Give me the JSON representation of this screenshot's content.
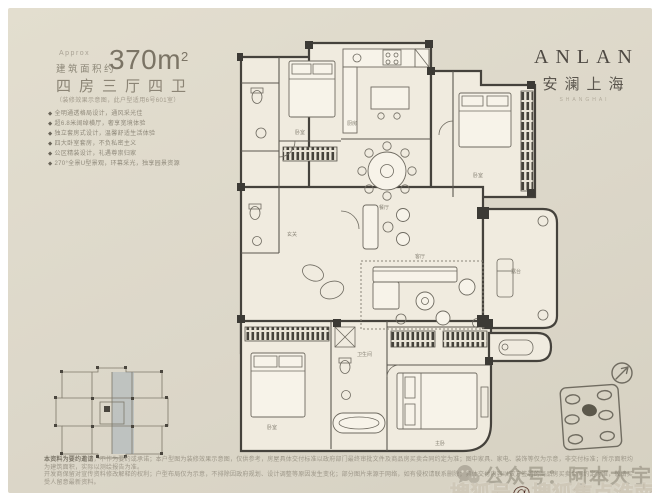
{
  "header": {
    "approx": "Approx",
    "area_label": "建筑面积约",
    "area_number": "370m",
    "area_sup": "2",
    "layout": "四房三厅四卫",
    "note": "（装修效果示意图，此户型适用6号601室）",
    "bullet": "◆",
    "features": [
      "全明通透格局设计，通风采光佳",
      "超6.8米阔绰横厅，奢享宽境体验",
      "独立套房式设计，温馨舒适生活体验",
      "四大卧室套房，不负私密主义",
      "公区精装设计，礼遇尊崇归家",
      "270°全景U型景观，环幕采光，独享园景资源"
    ]
  },
  "brand": {
    "name_en": "ANLAN",
    "name_cn": "安澜上海",
    "subtitle": "SHANGHAI"
  },
  "floorplan": {
    "labels": {
      "kitchen": "厨房",
      "dining": "餐厅",
      "living": "客厅",
      "master": "主卧",
      "bedroom2": "卧室",
      "bedroom3": "卧室",
      "bedroom4": "卧室",
      "terrace": "露台",
      "foyer": "玄关",
      "bath": "卫生间"
    }
  },
  "disclaimer": {
    "lead": "本资料为要约邀请",
    "line1": "，不作为要约或承诺；本户型图为装修效果示意图，仅供参考，房屋具体交付标准以政府部门最终审批文件及商品房买卖合同约定为准；图中家具、家电、装饰等仅为示意，非交付标准；所示面积均为建筑面积，实际以测绘报告为准。",
    "line2": "开发商保留对宣传资料修改解释的权利；户型布局仅为示意，不排除因政府规划、设计调整等原因发生变化；部分图片来源于网络，如有侵权请联系删除；具体交付内容以双方签署的商品房买卖合同约定为准，敬请买受人留意最新资料。"
  },
  "watermarks": {
    "wechat_label": "公众号：阿本大宇",
    "sohu_label": "搜狐号@搜狐焦点淮南站"
  },
  "colors": {
    "card_bg": "#dcd7c9",
    "wall": "#45423c",
    "accent_text": "#7b7465",
    "sohu_red": "#44211a",
    "keyplan_shade": "#9baab6"
  }
}
